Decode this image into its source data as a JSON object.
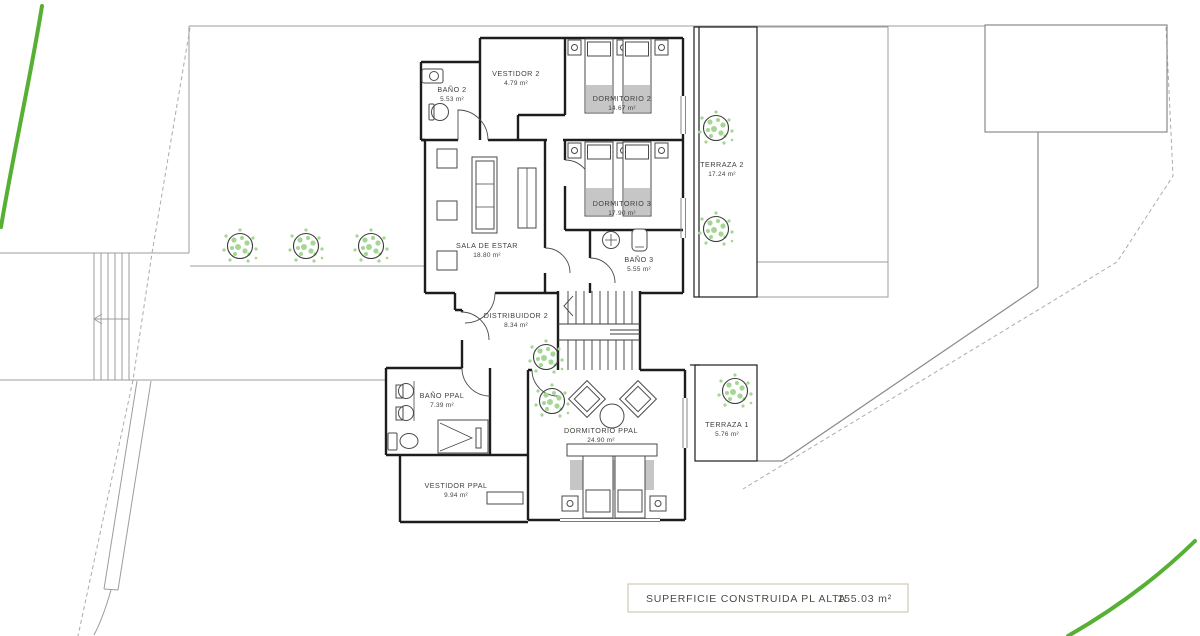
{
  "colors": {
    "wall": "#1d1d1b",
    "site": "#9c9c9c",
    "green": "#55b033",
    "treeDot": "#a5d693",
    "treeRing": "#3a3a3a",
    "furn": "#4a4a4a",
    "grayFill": "#c6c6c6",
    "label": "#3f3f3d",
    "boxBorder": "#d8d1c0",
    "boxText": "#4e4b43"
  },
  "rooms": [
    {
      "name": "BAÑO 2",
      "area": "5.53 m²"
    },
    {
      "name": "VESTIDOR 2",
      "area": "4.79 m²"
    },
    {
      "name": "DORMITORIO 2",
      "area": "14.67 m²"
    },
    {
      "name": "TERRAZA 2",
      "area": "17.24 m²"
    },
    {
      "name": "DORMITORIO 3",
      "area": "17.90 m²"
    },
    {
      "name": "SALA DE ESTAR",
      "area": "18.80 m²"
    },
    {
      "name": "BAÑO 3",
      "area": "5.55 m²"
    },
    {
      "name": "DISTRIBUIDOR 2",
      "area": "8.34 m²"
    },
    {
      "name": "BAÑO PPAL",
      "area": "7.39 m²"
    },
    {
      "name": "DORMITORIO PPAL",
      "area": "24.90 m²"
    },
    {
      "name": "TERRAZA 1",
      "area": "5.76 m²"
    },
    {
      "name": "VESTIDOR PPAL",
      "area": "9.94 m²"
    }
  ],
  "summary": {
    "label": "SUPERFICIE CONSTRUIDA PL ALTA",
    "value": "155.03 m²"
  }
}
